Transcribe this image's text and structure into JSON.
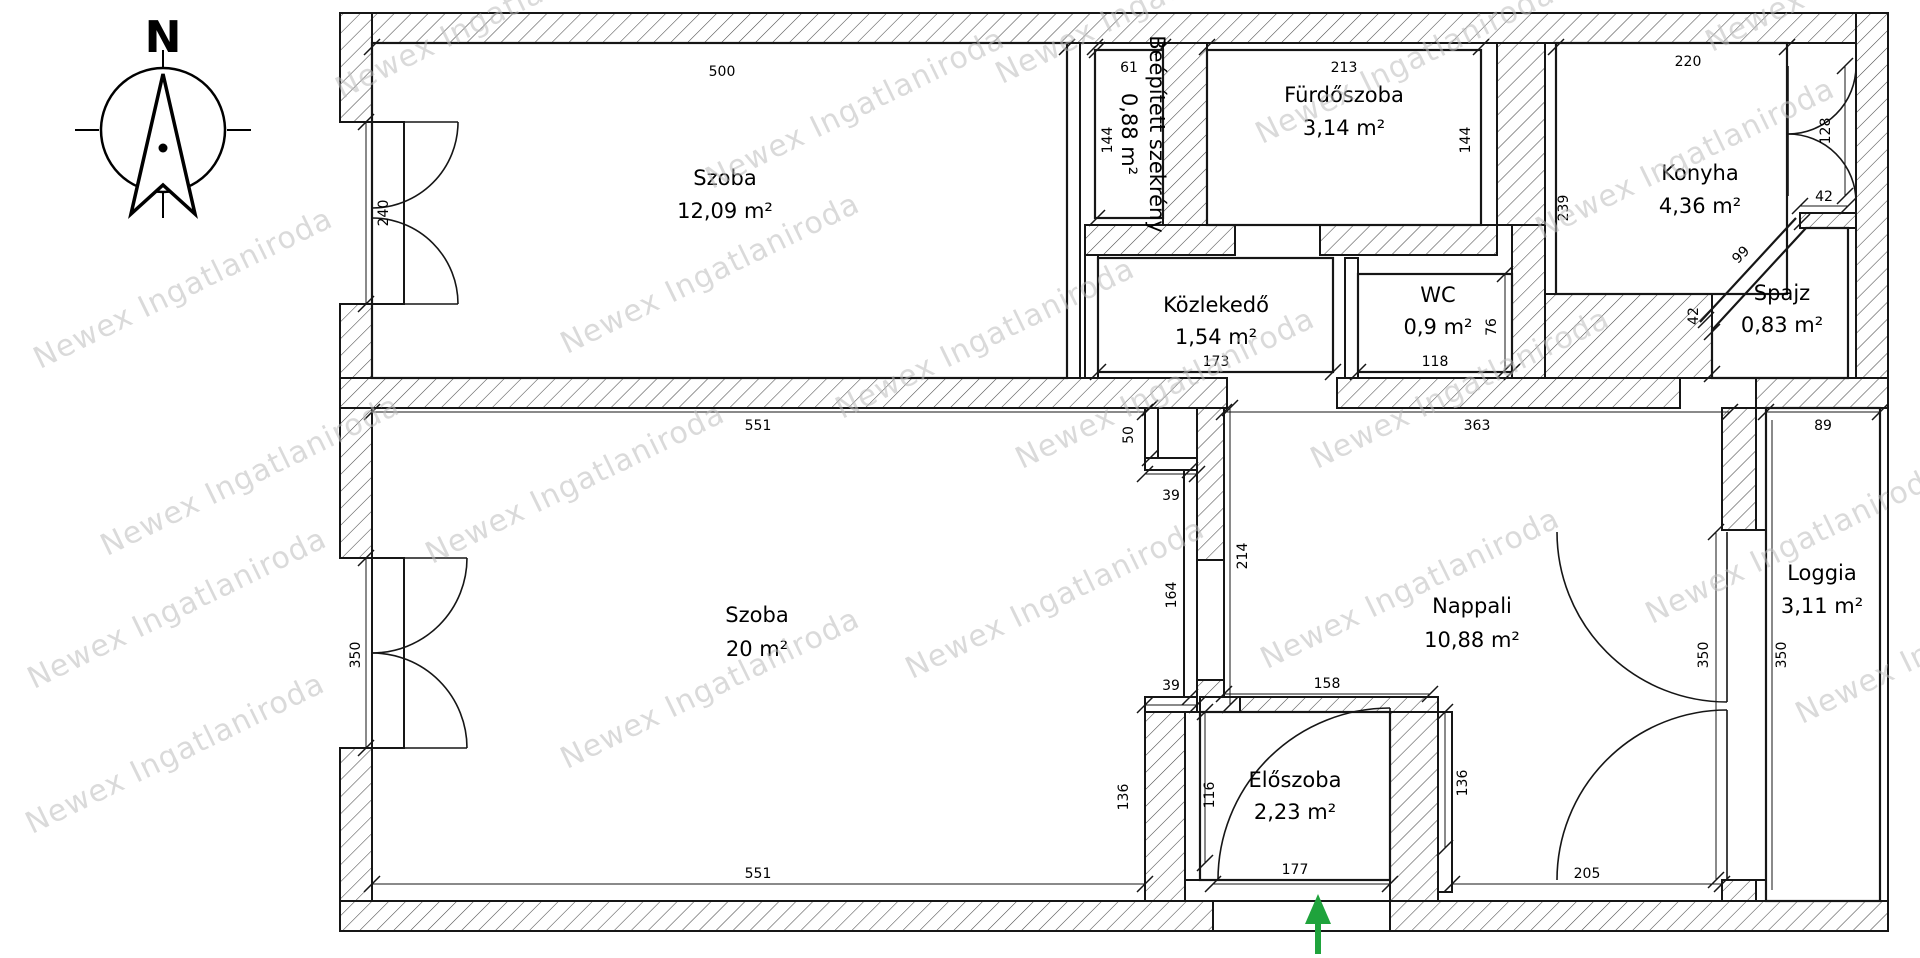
{
  "watermark": {
    "text": "Newex Ingatlaniroda",
    "color": "#bdbdbd",
    "positions": [
      [
        28,
        345
      ],
      [
        95,
        532
      ],
      [
        22,
        665
      ],
      [
        330,
        75
      ],
      [
        700,
        165
      ],
      [
        555,
        330
      ],
      [
        420,
        540
      ],
      [
        555,
        745
      ],
      [
        990,
        60
      ],
      [
        830,
        395
      ],
      [
        1010,
        445
      ],
      [
        900,
        655
      ],
      [
        1250,
        120
      ],
      [
        1530,
        215
      ],
      [
        1305,
        445
      ],
      [
        1255,
        645
      ],
      [
        1640,
        600
      ],
      [
        1700,
        28
      ],
      [
        1790,
        700
      ],
      [
        20,
        810
      ]
    ]
  },
  "compass": {
    "north_label": "N"
  },
  "rooms": {
    "szoba1": {
      "name": "Szoba",
      "area": "12,09 m²"
    },
    "szekreny": {
      "name": "Beépített szekrény",
      "area": "0,88 m²"
    },
    "furdoszoba": {
      "name": "Fürdőszoba",
      "area": "3,14 m²"
    },
    "konyha": {
      "name": "Konyha",
      "area": "4,36 m²"
    },
    "spajz": {
      "name": "Spajz",
      "area": "0,83 m²"
    },
    "kozlekedo": {
      "name": "Közlekedő",
      "area": "1,54 m²"
    },
    "wc": {
      "name": "WC",
      "area": "0,9 m²"
    },
    "szoba2": {
      "name": "Szoba",
      "area": "20 m²"
    },
    "nappali": {
      "name": "Nappali",
      "area": "10,88 m²"
    },
    "eloszoba": {
      "name": "Előszoba",
      "area": "2,23 m²"
    },
    "loggia": {
      "name": "Loggia",
      "area": "3,11 m²"
    }
  },
  "dims": {
    "d500": "500",
    "d240": "240",
    "d61": "61",
    "d144a": "144",
    "d213": "213",
    "d144b": "144",
    "d220": "220",
    "d239": "239",
    "d128": "128",
    "d42a": "42",
    "d99": "99",
    "d42b": "42",
    "d173": "173",
    "d118": "118",
    "d76": "76",
    "d551t": "551",
    "d551b": "551",
    "d350w": "350",
    "d50": "50",
    "d39a": "39",
    "d164": "164",
    "d39b": "39",
    "d214": "214",
    "d363": "363",
    "d158": "158",
    "d136l": "136",
    "d116": "116",
    "d177": "177",
    "d136r": "136",
    "d205": "205",
    "d350a": "350",
    "d350b": "350",
    "d89": "89"
  },
  "entrance": {
    "arrow_color": "#1fa33c"
  }
}
